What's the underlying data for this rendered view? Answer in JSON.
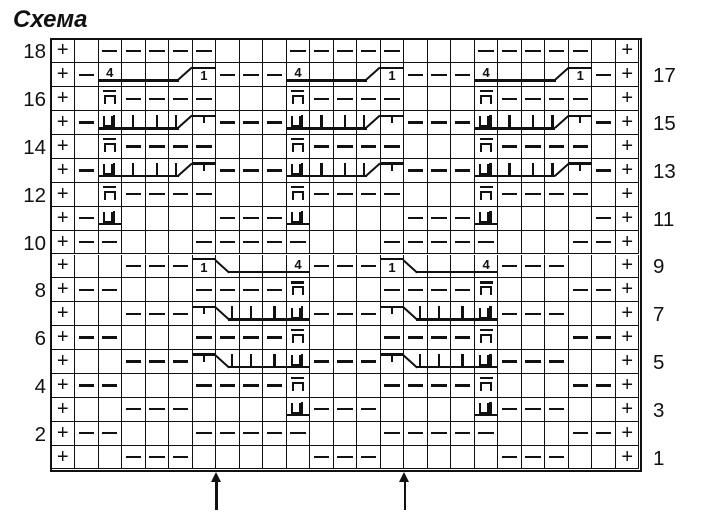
{
  "title": "Схема",
  "colors": {
    "ink": "#111111",
    "background": "#ffffff"
  },
  "chart": {
    "type": "knitting-chart",
    "columns": 25,
    "rows": 18,
    "row_numbers_left": [
      "18",
      "16",
      "14",
      "12",
      "10",
      "8",
      "6",
      "4",
      "2"
    ],
    "row_numbers_right": [
      "17",
      "15",
      "13",
      "11",
      "9",
      "7",
      "5",
      "3",
      "1"
    ],
    "symbol_legend": {
      "P": "edge-stitch-plus",
      "D": "purl-dash",
      "E": "empty-knit",
      "N": "p-with-macron",
      "U": "U-with-bar-underlined",
      "F": "digit-4-underlined",
      "L": "underline-continuation",
      "R": "underline-rising-diagonal",
      "O": "digit-1-overlined",
      "T": "tick-overlined",
      "J": "vertical-bar-underlined",
      "K": "vertical-bar-rising-diagonal",
      "f": "falling-diagonal-underline",
      "g": "falling-diagonal-vertical-bar"
    },
    "cells": [
      "PEDDDDDEEEDDDDDEEEDDDDDEP",
      "PDFLLRODDDFLLRODDDFLLRODP",
      "PENDDDDEEENDDDDEEENDDDDEP",
      "PDUJJKTDDDUJJKTDDDUJJKTDP",
      "PENDDDDEEENDDDDEEENDDDDEP",
      "PDUJJKTDDDUJJKTDDDUJJKTDP",
      "PENDDDDEEENDDDDEEENDDDDEP",
      "PDUEEEEDDDUEEEEDDDUEEEEDP",
      "PDDEEEDDDDDEEEDDDDDEEEDDP",
      "PEEDDDOfLLFDDDOfLLFDDDEEP",
      "PDDEEEDDDDNEEEDDDDNEEEDDP",
      "PEEDDDTgJJUDDDTgJJUDDDEEP",
      "PDDEEEDDDDNEEEDDDDNEEEDDP",
      "PEEDDDTgJJUDDDTgJJUDDDEEP",
      "PDDEEEDDDDNEEEDDDDNEEEDDP",
      "PEEDDDEEEEUDDDEEEEUDDDEEP",
      "PDDEEEDDDDDEEEDDDDDEEEDDP",
      "PEEDDDEEEEEDDDEEEEEDDDEEP"
    ],
    "repeat_arrow_columns": [
      8,
      16
    ]
  }
}
